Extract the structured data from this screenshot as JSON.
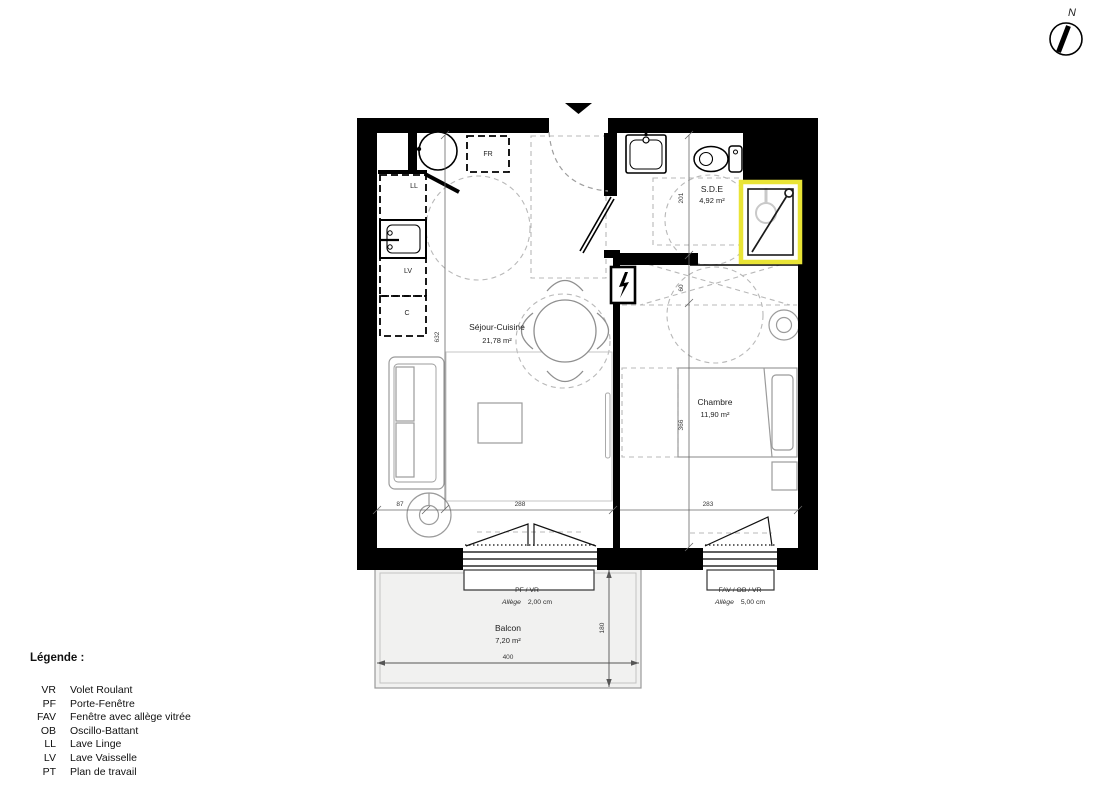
{
  "plan": {
    "compass_label": "N",
    "rooms": {
      "sejour": {
        "name": "Séjour-Cuisine",
        "area": "21,78 m²"
      },
      "sde": {
        "name": "S.D.E",
        "area": "4,92 m²"
      },
      "chambre": {
        "name": "Chambre",
        "area": "11,90 m²"
      },
      "balcon": {
        "name": "Balcon",
        "area": "7,20 m²"
      }
    },
    "kitchen": {
      "fr": "FR",
      "ll": "LL",
      "lv": "LV",
      "c": "C"
    },
    "windows": {
      "sejour": {
        "type": "PF / VR",
        "allege_label": "Allège",
        "allege_value": "2,00  cm"
      },
      "chambre": {
        "type": "FAV / OB / VR",
        "allege_label": "Allège",
        "allege_value": "5,00  cm"
      }
    },
    "dimensions": {
      "sejour_height": "632",
      "sde_height": "201",
      "niche": "60",
      "chambre_height": "366",
      "sofa": "87",
      "sejour_width": "288",
      "chambre_width": "283",
      "balcon_width": "400",
      "balcon_depth": "180"
    }
  },
  "legend": {
    "title": "Légende :",
    "items": [
      {
        "abbr": "VR",
        "label": "Volet Roulant"
      },
      {
        "abbr": "PF",
        "label": "Porte-Fenêtre"
      },
      {
        "abbr": "FAV",
        "label": "Fenêtre avec allège vitrée"
      },
      {
        "abbr": "OB",
        "label": "Oscillo-Battant"
      },
      {
        "abbr": "LL",
        "label": "Lave Linge"
      },
      {
        "abbr": "LV",
        "label": "Lave Vaisselle"
      },
      {
        "abbr": "PT",
        "label": "Plan de travail"
      }
    ]
  },
  "colors": {
    "wall": "#000000",
    "shower_highlight": "#e9e436",
    "furniture": "#9b9b9b",
    "guide": "#b8b8b8",
    "balcony_fill": "#f1f1f0"
  }
}
